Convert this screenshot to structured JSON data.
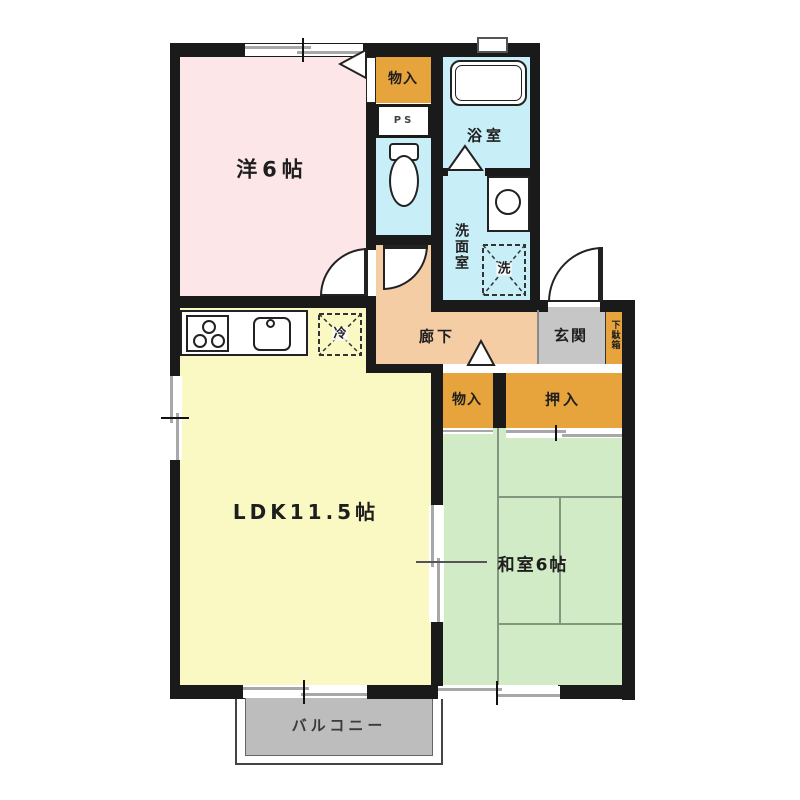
{
  "floorplan": {
    "rooms": {
      "western_room": {
        "label": "洋6帖"
      },
      "ldk": {
        "label": "LDK11.5帖"
      },
      "japanese_room": {
        "label": "和室6帖"
      },
      "bathroom": {
        "label": "浴室"
      },
      "washroom": {
        "label": "洗面室"
      },
      "hallway": {
        "label": "廊下"
      },
      "entrance": {
        "label": "玄関"
      },
      "balcony": {
        "label": "バルコニー"
      }
    },
    "storage": {
      "upper_closet": {
        "label": "物入"
      },
      "lower_closet": {
        "label": "物入"
      },
      "oshiire": {
        "label": "押入"
      },
      "shoe_cabinet": {
        "label": "下駄箱"
      }
    },
    "utilities": {
      "pipe_space": {
        "label": "PS"
      },
      "washing_machine": {
        "label": "洗"
      },
      "refrigerator": {
        "label": "冷"
      }
    },
    "colors": {
      "wall": "#1a1a1a",
      "western_room": "#fce6e8",
      "ldk": "#faf8c3",
      "japanese_room": "#d0ebc5",
      "hallway": "#f5cda5",
      "wet_area": "#c8eef7",
      "storage": "#e8a43c",
      "entrance": "#c6c6c6",
      "balcony": "#bdbdbd"
    }
  }
}
